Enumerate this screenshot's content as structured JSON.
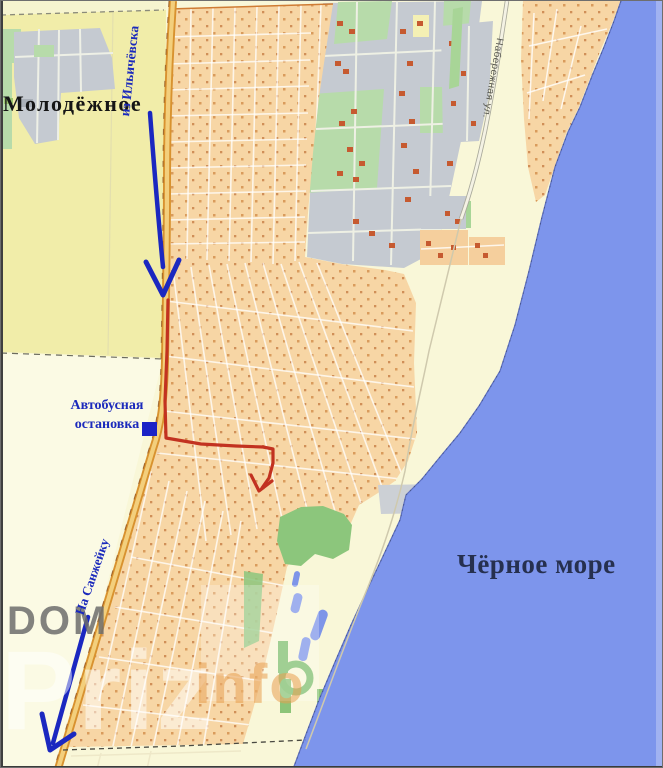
{
  "map": {
    "place_labels": {
      "settlement": "Молодёжное",
      "sea": "Чёрное море"
    },
    "route_labels": {
      "from_road": "из Ильичёвска",
      "to_road": "На Санжейку",
      "bus_stop_line1": "Автобусная",
      "bus_stop_line2": "остановка"
    },
    "street_labels": {
      "coastal_street": "Набережная ул."
    },
    "watermark": {
      "dom": "DOM",
      "priz": "Priz",
      "info": "info"
    },
    "colors": {
      "sea": "#7d95ec",
      "land_base": "#f9f7d8",
      "field_yellow": "#f1eda9",
      "residential_orange": "#f7d6a5",
      "industrial_gray": "#c5cad1",
      "park_green": "#8cc67c",
      "light_green": "#b7dbaa",
      "road_casing": "#d8922f",
      "road_fill": "#f3cf7c",
      "route_red": "#c23220",
      "arrow_blue": "#1b28c0",
      "label_blue": "#1b2abc",
      "sea_label_navy": "#26304f"
    }
  }
}
